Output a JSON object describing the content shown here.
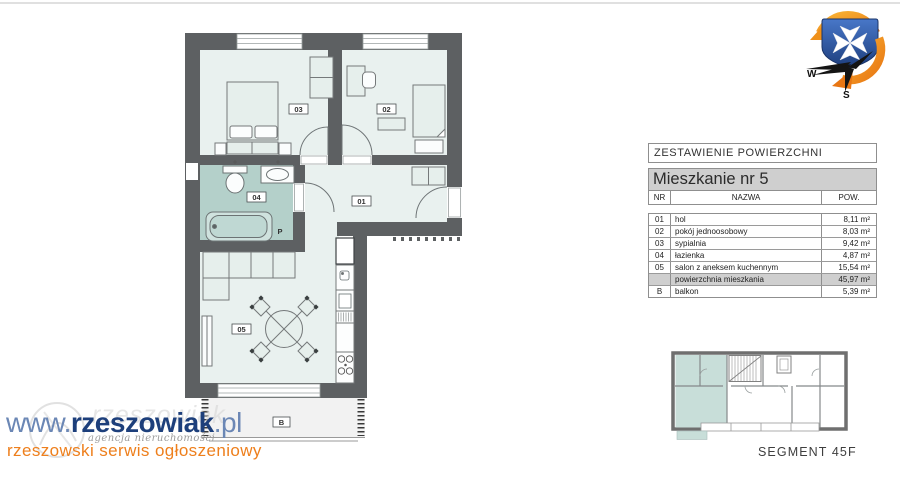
{
  "header": {
    "top_rule_color": "#e0e0e0"
  },
  "floor_plan": {
    "labels": {
      "hol": "01",
      "pokoj": "02",
      "sypialnia": "03",
      "lazienka": "04",
      "salon": "05",
      "balkon": "B",
      "pralka": "P"
    },
    "colors": {
      "wall": "#5d6062",
      "floor": "#e9f1ef",
      "bathroom": "#b4d0ca",
      "balcony": "#f2f2f2"
    }
  },
  "area_table": {
    "title": "ZESTAWIENIE POWIERZCHNI",
    "subtitle": "Mieszkanie nr 5",
    "columns": {
      "nr": "NR",
      "nazwa": "NAZWA",
      "pow": "POW."
    },
    "rows": [
      {
        "nr": "01",
        "nazwa": "hol",
        "pow": "8,11 m²"
      },
      {
        "nr": "02",
        "nazwa": "pokój jednoosobowy",
        "pow": "8,03 m²"
      },
      {
        "nr": "03",
        "nazwa": "sypialnia",
        "pow": "9,42 m²"
      },
      {
        "nr": "04",
        "nazwa": "łazienka",
        "pow": "4,87 m²"
      },
      {
        "nr": "05",
        "nazwa": "salon z aneksem kuchennym",
        "pow": "15,54 m²"
      }
    ],
    "total_row": {
      "nr": "",
      "nazwa": "powierzchnia mieszkania",
      "pow": "45,97 m²"
    },
    "balcony_row": {
      "nr": "B",
      "nazwa": "balkon",
      "pow": "5,39 m²"
    }
  },
  "key_plan": {
    "caption": "SEGMENT 45F",
    "highlight_color": "#c8ded9"
  },
  "compass": {
    "west_label": "W",
    "south_label": "S",
    "shield_color": "#2a55a4",
    "swirl_color": "#ef8c16"
  },
  "watermark": {
    "url_prefix": "www.",
    "url_main": "rzeszowiak",
    "url_suffix": ".pl",
    "ghost_text": "rzeszowiak",
    "script_line": "agencja nieruchomości",
    "tagline": "rzeszowski serwis ogłoszeniowy",
    "colors": {
      "blue_dark": "#1d3f7b",
      "blue_light": "#6b87b5",
      "orange": "#ee7f1c"
    }
  }
}
